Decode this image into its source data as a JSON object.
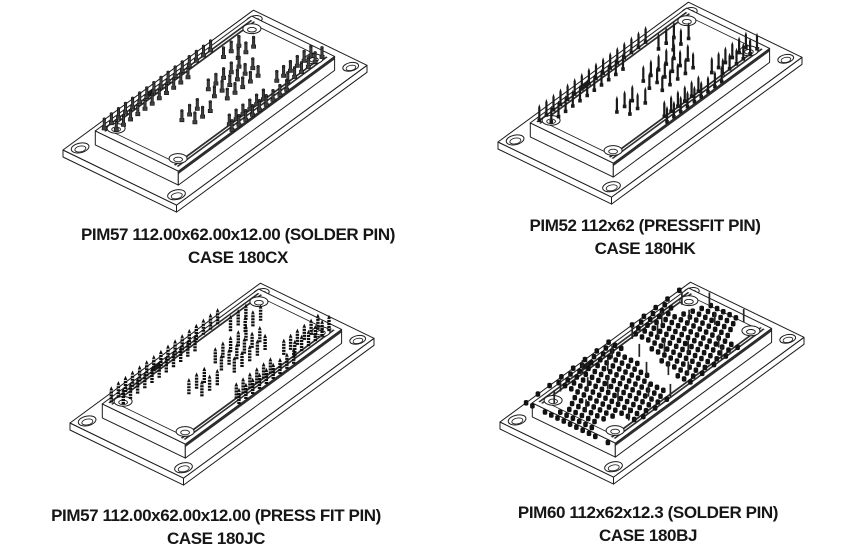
{
  "sheet": {
    "background": "#ffffff",
    "description": "Four isometric package outline drawings of IGBT power integrated modules"
  },
  "colors": {
    "line": "#1c1c1c",
    "pin_dark": "#161616",
    "caption_text": "#161616"
  },
  "figures": [
    {
      "name": "pim57-solder-pin",
      "drawing": "igbt-power-module-isometric",
      "pin_style": "solder",
      "caption_line1": "PIM57 112.00x62.00x12.00 (SOLDER PIN)",
      "caption_line2": "CASE 180CX"
    },
    {
      "name": "pim52-pressfit-pin",
      "drawing": "igbt-power-module-isometric",
      "pin_style": "pressfit",
      "caption_line1": "PIM52 112x62 (PRESSFIT PIN)",
      "caption_line2": "CASE 180HK"
    },
    {
      "name": "pim57-press-fit-pin",
      "drawing": "igbt-power-module-isometric",
      "pin_style": "pressfit-ribbed",
      "caption_line1": "PIM57 112.00x62.00x12.00 (PRESS FIT PIN)",
      "caption_line2": "CASE 180JC"
    },
    {
      "name": "pim60-solder-pin-grid",
      "drawing": "igbt-power-module-isometric",
      "pin_style": "pin-grid",
      "caption_line1": "PIM60 112x62x12.3 (SOLDER PIN)",
      "caption_line2": "CASE 180BJ"
    }
  ]
}
